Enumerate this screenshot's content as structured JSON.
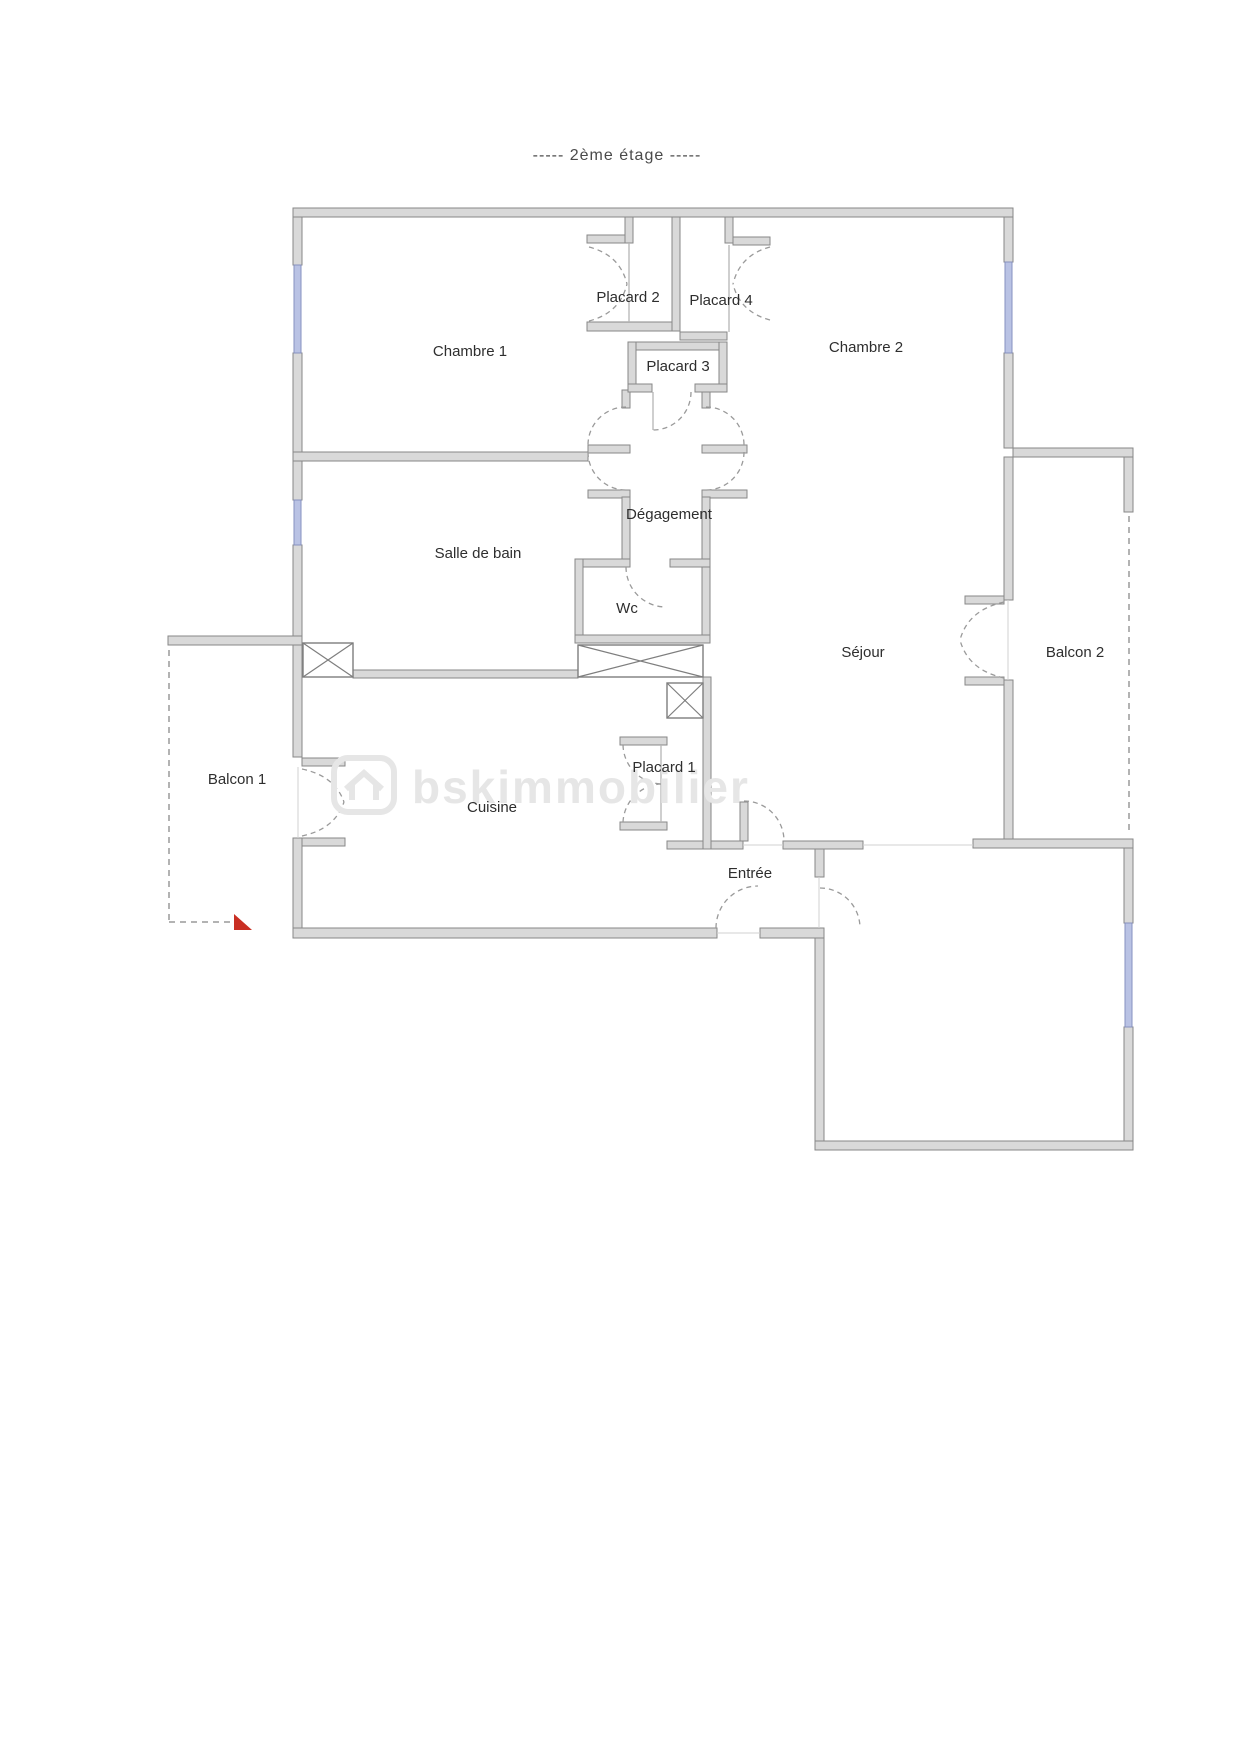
{
  "title": "-----  2ème étage  -----",
  "watermark": {
    "text": "bskimmobilier",
    "icon": "house-logo-icon"
  },
  "rooms": [
    {
      "label": "Chambre 1"
    },
    {
      "label": "Placard 2"
    },
    {
      "label": "Placard 4"
    },
    {
      "label": "Chambre 2"
    },
    {
      "label": "Placard 3"
    },
    {
      "label": "Dégagement"
    },
    {
      "label": "Salle de bain"
    },
    {
      "label": "Wc"
    },
    {
      "label": "Séjour"
    },
    {
      "label": "Balcon 2"
    },
    {
      "label": "Balcon 1"
    },
    {
      "label": "Cuisine"
    },
    {
      "label": "Placard 1"
    },
    {
      "label": "Entrée"
    }
  ],
  "colors": {
    "wall_fill": "#d9d9d9",
    "wall_edge": "#878787",
    "window_blue": "#b9c2e4",
    "label_text": "#2e2e2e",
    "watermark_gray": "#e6e6e6",
    "red_marker": "#c92f23"
  }
}
